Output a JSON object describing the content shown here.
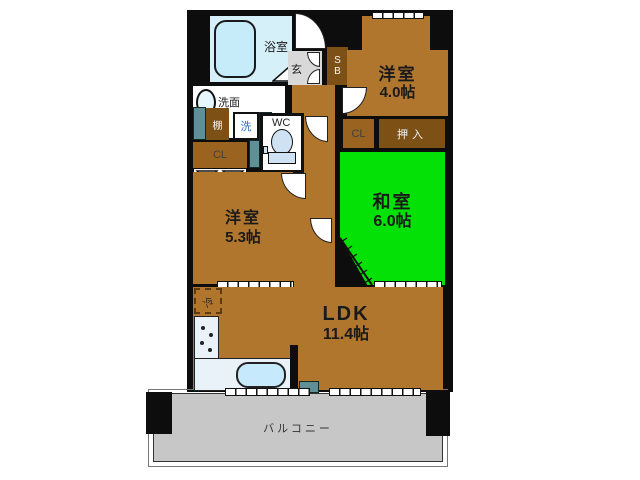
{
  "plan_title": "apartment-floor-plan",
  "rooms": {
    "bathroom": {
      "label": "浴室"
    },
    "genkan": {
      "label": "玄"
    },
    "shoebox": {
      "l1": "S",
      "l2": "B"
    },
    "western1": {
      "name": "洋室",
      "size": "4.0帖"
    },
    "cl_top": {
      "label": "CL"
    },
    "oshiire": {
      "label": "押入"
    },
    "washitsu": {
      "name": "和室",
      "size": "6.0帖"
    },
    "senmen": {
      "label": "洗面"
    },
    "shelf": {
      "label": "棚"
    },
    "washer": {
      "label": "洗"
    },
    "wc": {
      "label": "WC"
    },
    "cl_left": {
      "label": "CL"
    },
    "western2": {
      "name": "洋室",
      "size": "5.3帖"
    },
    "ldk": {
      "name": "LDK",
      "size": "11.4帖"
    },
    "fridge": {
      "label": "冷"
    },
    "balcony": {
      "label": "バルコニー"
    }
  },
  "colors": {
    "wall": "#0d0d0d",
    "room_brown": "#b1762e",
    "storage_dark_brown": "#7d5116",
    "closet_brown": "#9a6420",
    "tatami_green": "#04e106",
    "bath_blue": "#d6f0fa",
    "fixture_blue": "#c6eafc",
    "balcony_gray": "#c7c7c7",
    "genkan_gray": "#d9d9d9",
    "teal": "#5f8f97"
  }
}
